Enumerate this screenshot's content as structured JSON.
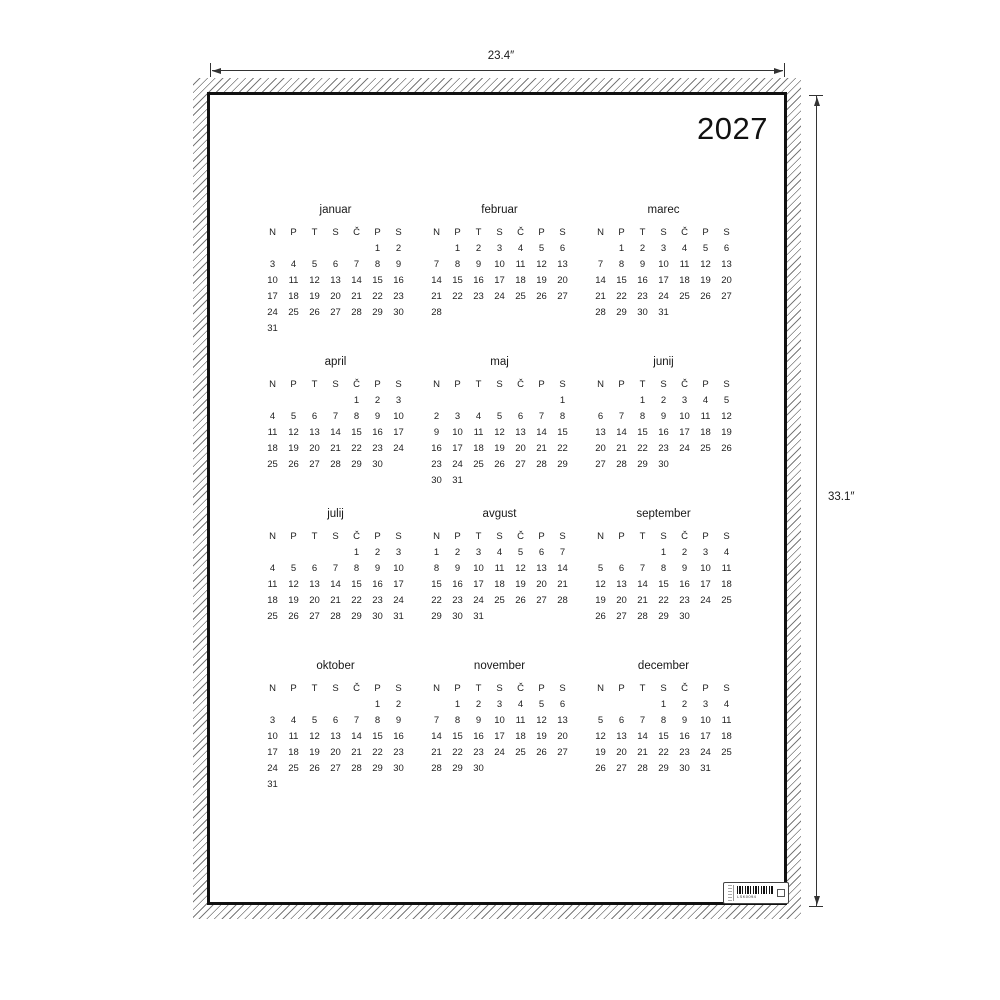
{
  "dimensions": {
    "width_label": "23.4″",
    "height_label": "33.1″"
  },
  "poster": {
    "year": "2027",
    "day_headers": [
      "N",
      "P",
      "T",
      "S",
      "Č",
      "P",
      "S"
    ],
    "months": [
      {
        "name": "januar",
        "weeks": [
          [
            "",
            "",
            "",
            "",
            "",
            "1",
            "2"
          ],
          [
            "3",
            "4",
            "5",
            "6",
            "7",
            "8",
            "9"
          ],
          [
            "10",
            "11",
            "12",
            "13",
            "14",
            "15",
            "16"
          ],
          [
            "17",
            "18",
            "19",
            "20",
            "21",
            "22",
            "23"
          ],
          [
            "24",
            "25",
            "26",
            "27",
            "28",
            "29",
            "30"
          ],
          [
            "31",
            "",
            "",
            "",
            "",
            "",
            ""
          ]
        ]
      },
      {
        "name": "februar",
        "weeks": [
          [
            "",
            "1",
            "2",
            "3",
            "4",
            "5",
            "6"
          ],
          [
            "7",
            "8",
            "9",
            "10",
            "11",
            "12",
            "13"
          ],
          [
            "14",
            "15",
            "16",
            "17",
            "18",
            "19",
            "20"
          ],
          [
            "21",
            "22",
            "23",
            "24",
            "25",
            "26",
            "27"
          ],
          [
            "28",
            "",
            "",
            "",
            "",
            "",
            ""
          ]
        ]
      },
      {
        "name": "marec",
        "weeks": [
          [
            "",
            "1",
            "2",
            "3",
            "4",
            "5",
            "6"
          ],
          [
            "7",
            "8",
            "9",
            "10",
            "11",
            "12",
            "13"
          ],
          [
            "14",
            "15",
            "16",
            "17",
            "18",
            "19",
            "20"
          ],
          [
            "21",
            "22",
            "23",
            "24",
            "25",
            "26",
            "27"
          ],
          [
            "28",
            "29",
            "30",
            "31",
            "",
            "",
            ""
          ]
        ]
      },
      {
        "name": "april",
        "weeks": [
          [
            "",
            "",
            "",
            "",
            "1",
            "2",
            "3"
          ],
          [
            "4",
            "5",
            "6",
            "7",
            "8",
            "9",
            "10"
          ],
          [
            "11",
            "12",
            "13",
            "14",
            "15",
            "16",
            "17"
          ],
          [
            "18",
            "19",
            "20",
            "21",
            "22",
            "23",
            "24"
          ],
          [
            "25",
            "26",
            "27",
            "28",
            "29",
            "30",
            ""
          ]
        ]
      },
      {
        "name": "maj",
        "weeks": [
          [
            "",
            "",
            "",
            "",
            "",
            "",
            "1"
          ],
          [
            "2",
            "3",
            "4",
            "5",
            "6",
            "7",
            "8"
          ],
          [
            "9",
            "10",
            "11",
            "12",
            "13",
            "14",
            "15"
          ],
          [
            "16",
            "17",
            "18",
            "19",
            "20",
            "21",
            "22"
          ],
          [
            "23",
            "24",
            "25",
            "26",
            "27",
            "28",
            "29"
          ],
          [
            "30",
            "31",
            "",
            "",
            "",
            "",
            ""
          ]
        ]
      },
      {
        "name": "junij",
        "weeks": [
          [
            "",
            "",
            "1",
            "2",
            "3",
            "4",
            "5"
          ],
          [
            "6",
            "7",
            "8",
            "9",
            "10",
            "11",
            "12"
          ],
          [
            "13",
            "14",
            "15",
            "16",
            "17",
            "18",
            "19"
          ],
          [
            "20",
            "21",
            "22",
            "23",
            "24",
            "25",
            "26"
          ],
          [
            "27",
            "28",
            "29",
            "30",
            "",
            "",
            ""
          ]
        ]
      },
      {
        "name": "julij",
        "weeks": [
          [
            "",
            "",
            "",
            "",
            "1",
            "2",
            "3"
          ],
          [
            "4",
            "5",
            "6",
            "7",
            "8",
            "9",
            "10"
          ],
          [
            "11",
            "12",
            "13",
            "14",
            "15",
            "16",
            "17"
          ],
          [
            "18",
            "19",
            "20",
            "21",
            "22",
            "23",
            "24"
          ],
          [
            "25",
            "26",
            "27",
            "28",
            "29",
            "30",
            "31"
          ]
        ]
      },
      {
        "name": "avgust",
        "weeks": [
          [
            "1",
            "2",
            "3",
            "4",
            "5",
            "6",
            "7"
          ],
          [
            "8",
            "9",
            "10",
            "11",
            "12",
            "13",
            "14"
          ],
          [
            "15",
            "16",
            "17",
            "18",
            "19",
            "20",
            "21"
          ],
          [
            "22",
            "23",
            "24",
            "25",
            "26",
            "27",
            "28"
          ],
          [
            "29",
            "30",
            "31",
            "",
            "",
            "",
            ""
          ]
        ]
      },
      {
        "name": "september",
        "weeks": [
          [
            "",
            "",
            "",
            "1",
            "2",
            "3",
            "4"
          ],
          [
            "5",
            "6",
            "7",
            "8",
            "9",
            "10",
            "11"
          ],
          [
            "12",
            "13",
            "14",
            "15",
            "16",
            "17",
            "18"
          ],
          [
            "19",
            "20",
            "21",
            "22",
            "23",
            "24",
            "25"
          ],
          [
            "26",
            "27",
            "28",
            "29",
            "30",
            "",
            ""
          ]
        ]
      },
      {
        "name": "oktober",
        "weeks": [
          [
            "",
            "",
            "",
            "",
            "",
            "1",
            "2"
          ],
          [
            "3",
            "4",
            "5",
            "6",
            "7",
            "8",
            "9"
          ],
          [
            "10",
            "11",
            "12",
            "13",
            "14",
            "15",
            "16"
          ],
          [
            "17",
            "18",
            "19",
            "20",
            "21",
            "22",
            "23"
          ],
          [
            "24",
            "25",
            "26",
            "27",
            "28",
            "29",
            "30"
          ],
          [
            "31",
            "",
            "",
            "",
            "",
            "",
            ""
          ]
        ]
      },
      {
        "name": "november",
        "weeks": [
          [
            "",
            "1",
            "2",
            "3",
            "4",
            "5",
            "6"
          ],
          [
            "7",
            "8",
            "9",
            "10",
            "11",
            "12",
            "13"
          ],
          [
            "14",
            "15",
            "16",
            "17",
            "18",
            "19",
            "20"
          ],
          [
            "21",
            "22",
            "23",
            "24",
            "25",
            "26",
            "27"
          ],
          [
            "28",
            "29",
            "30",
            "",
            "",
            "",
            ""
          ]
        ]
      },
      {
        "name": "december",
        "weeks": [
          [
            "",
            "",
            "",
            "1",
            "2",
            "3",
            "4"
          ],
          [
            "5",
            "6",
            "7",
            "8",
            "9",
            "10",
            "11"
          ],
          [
            "12",
            "13",
            "14",
            "15",
            "16",
            "17",
            "18"
          ],
          [
            "19",
            "20",
            "21",
            "22",
            "23",
            "24",
            "25"
          ],
          [
            "26",
            "27",
            "28",
            "29",
            "30",
            "31",
            ""
          ]
        ]
      }
    ],
    "product_label": {
      "code": "LSK0094"
    }
  }
}
